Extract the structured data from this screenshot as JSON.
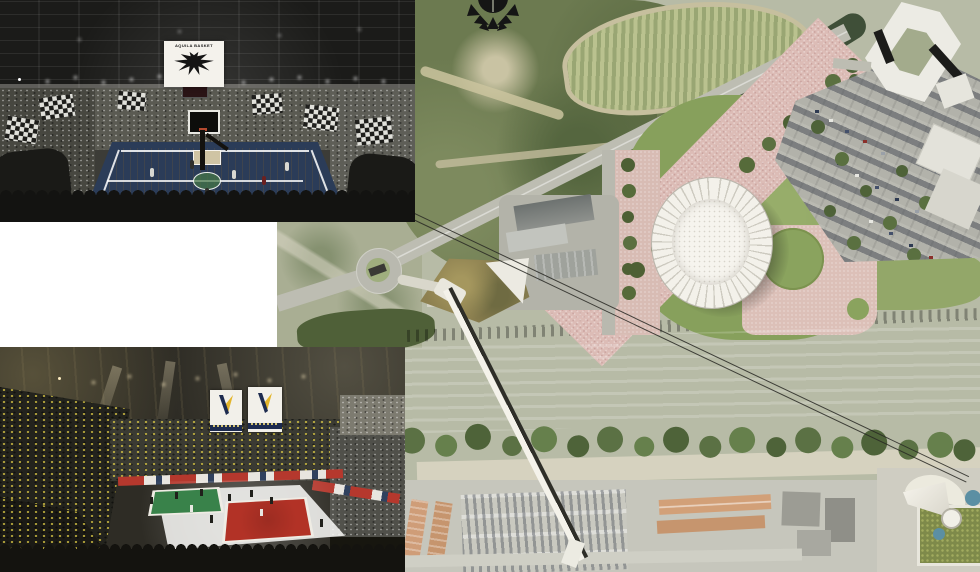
{
  "panels": {
    "basketball_photo": {
      "description": "basketball arena interior rendering with black-and-white checkered crowd flags",
      "banner": {
        "text": "AQUILA BASKET",
        "icon": "eagle-emblem"
      }
    },
    "volleyball_photo": {
      "description": "volleyball arena interior rendering with yellow-and-navy crowd",
      "banners": {
        "icon": "trentino-volley-v-logo",
        "count": 2
      }
    },
    "blank_panel": {
      "description": "white spacer panel"
    },
    "masterplan": {
      "description": "aerial site masterplan render",
      "emblem_icon": "winged-ball-crest",
      "features": [
        "oval arena roof",
        "pink paved plaza",
        "lawn with tree rows",
        "large parking lot",
        "roundabout",
        "highway",
        "railway line",
        "river",
        "riverside tree band",
        "pedestrian bridge",
        "cableway line",
        "hexagonal ring building",
        "green-roof cable station",
        "vineyard hillside",
        "industrial sheds",
        "orange-roof housing rows",
        "south parking lot"
      ]
    }
  },
  "colors": {
    "plaza_pink": "#dcbcb6",
    "lawn_green": "#87a05c",
    "tree_green": "#4d6034",
    "river": "#cbd1c2",
    "arena_white": "#f3f1ea",
    "railway_brown": "#71594f",
    "court_wood": "#c6a06b",
    "court_navy": "#2b3c58",
    "volley_teal": "#79bac9",
    "volley_red": "#b23226",
    "volley_green": "#39824a",
    "volley_yellow": "#e3b52c",
    "banner_navy": "#1d2b4f"
  }
}
